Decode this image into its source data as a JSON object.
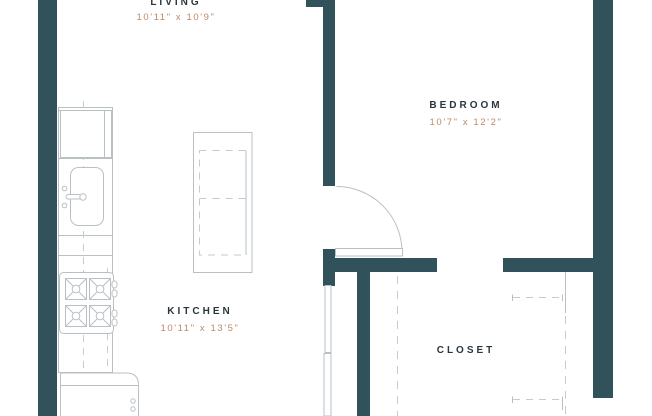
{
  "rooms": {
    "living": {
      "label": "LIVING",
      "dims": "10'11\" x 10'9\""
    },
    "bedroom": {
      "label": "BEDROOM",
      "dims": "10'7\" x 12'2\""
    },
    "kitchen": {
      "label": "KITCHEN",
      "dims": "10'11\" x 13'5\""
    },
    "closet": {
      "label": "CLOSET"
    }
  },
  "colors": {
    "bg": "#ffffff",
    "wall": "#31525b",
    "line": "#b9c0c4",
    "dash": "#c5cbce",
    "label": "#2a363d",
    "dim": "#bd8a66"
  }
}
